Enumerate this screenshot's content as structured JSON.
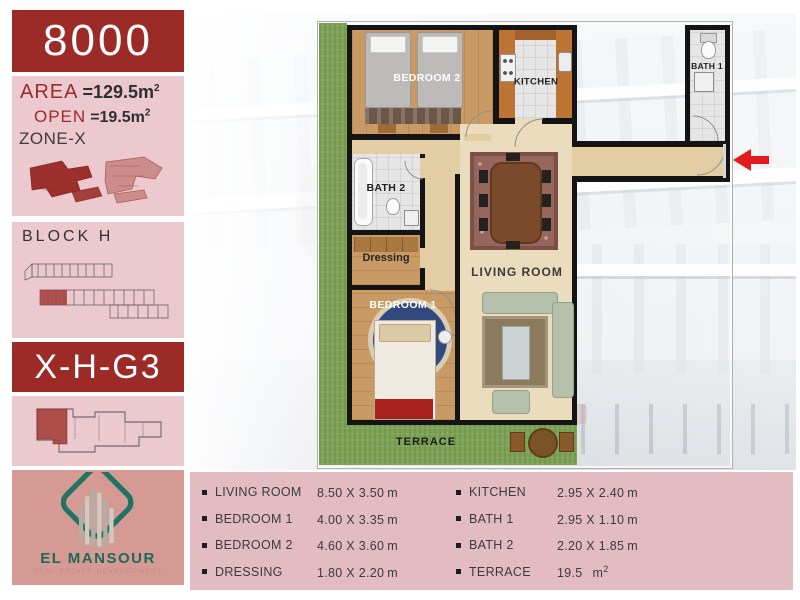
{
  "sidebar": {
    "unit_number": "8000",
    "area_label": "AREA",
    "area_value": "=129.5m",
    "area_sup": "2",
    "open_label": "OPEN",
    "open_value": "=19.5m",
    "open_sup": "2",
    "zone_label": "ZONE-X",
    "block_label": "BLOCK H",
    "unit_code": "X-H-G3",
    "brand_name": "EL MANSOUR",
    "brand_tagline": "REAL ESTATE DEVELOPMENT"
  },
  "floor_plan": {
    "labels": {
      "bedroom2": "BEDROOM 2",
      "kitchen": "KITCHEN",
      "bath1": "BATH 1",
      "bath2": "BATH 2",
      "dressing": "Dressing",
      "bedroom1": "BEDROOM 1",
      "living": "LIVING ROOM",
      "terrace": "TERRACE"
    }
  },
  "dimensions": {
    "col1": [
      {
        "name": "LIVING ROOM",
        "size": "8.50 X 3.50",
        "unit": "m"
      },
      {
        "name": "BEDROOM 1",
        "size": "4.00 X 3.35",
        "unit": "m"
      },
      {
        "name": "BEDROOM 2",
        "size": "4.60 X 3.60",
        "unit": "m"
      },
      {
        "name": "DRESSING",
        "size": "1.80 X 2.20",
        "unit": "m"
      }
    ],
    "col2": [
      {
        "name": "KITCHEN",
        "size": "2.95 X 2.40",
        "unit": "m"
      },
      {
        "name": "BATH 1",
        "size": "2.95 X 1.10",
        "unit": "m"
      },
      {
        "name": "BATH 2",
        "size": "2.20 X 1.85",
        "unit": "m"
      },
      {
        "name": "TERRACE",
        "size": "19.5",
        "unit": "m",
        "sup": "2"
      }
    ]
  },
  "colors": {
    "brand_red": "#9c2b28",
    "panel_pink": "#ecc9ce",
    "table_pink": "#e2bcc2",
    "logo_panel": "#d59a93",
    "logo_green": "#1e7362",
    "arrow_red": "#e6191d"
  }
}
